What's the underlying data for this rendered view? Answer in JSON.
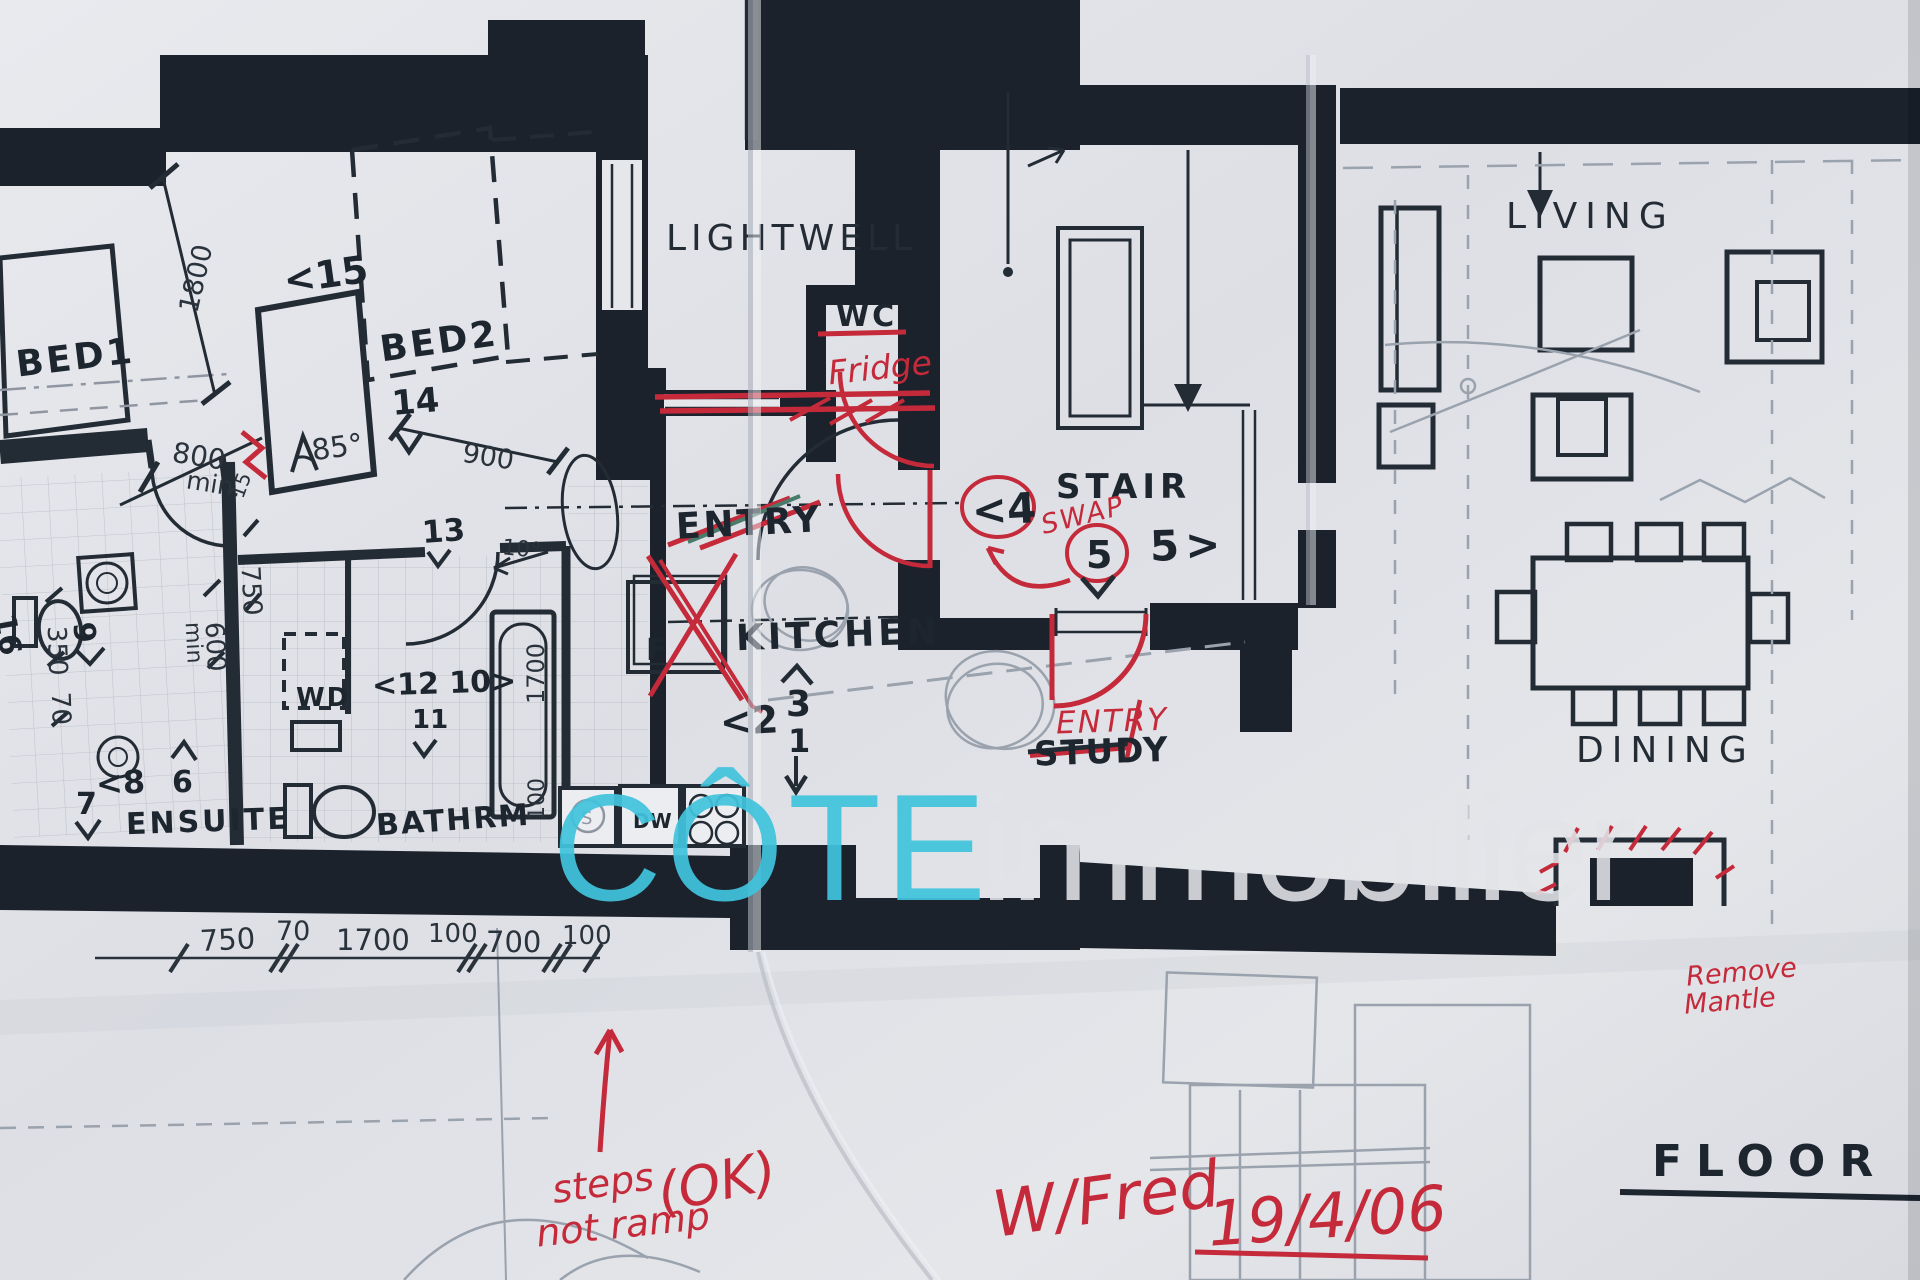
{
  "watermark": {
    "brand": "CÔTE",
    "suffix": "immobilier",
    "brand_color": "#41c4dd",
    "suffix_color": "#e3e4e8"
  },
  "title": {
    "floor_plan": "FLOOR PLA"
  },
  "rooms": {
    "bed1": "BED1",
    "bed2": "BED2",
    "lightwell": "LIGHTWELL",
    "wc": "WC",
    "kitchen": "KITCHEN",
    "entry_old": "ENTRY",
    "stair": "STAIR",
    "living": "LIVING",
    "dining": "DINING",
    "ensuite": "ENSUITE",
    "bathroom": "BATHRM",
    "laundry": "WD",
    "study_old": "STUDY",
    "fridge_box": "F",
    "dishwasher": "DW",
    "sink": "S"
  },
  "red_notes": {
    "fridge": "Fridge",
    "swap": "SWAP",
    "entry_new": "ENTRY",
    "steps": "steps",
    "ramp": "not ramp",
    "ok": "(OK)",
    "meeting": "W/Fred",
    "date": "19/4/06",
    "mantle_line1": "Remove",
    "mantle_line2": "Mantle"
  },
  "markers": {
    "m1": "1",
    "m2": "<2",
    "m3": "3",
    "m4": "<4",
    "m5": "5",
    "m5r": "5>",
    "m6": "6",
    "m7": "7",
    "m8": "<8",
    "m9": "9",
    "m11": "11",
    "m12_10": "<12 10>",
    "m13": "13",
    "m14": "14",
    "m15": "<15",
    "m16": "16"
  },
  "dims": {
    "d1800": "1800",
    "d800": "800",
    "dmin800": "min.",
    "d900": "900",
    "a10": "10°",
    "a85": "85°",
    "d15": "15",
    "d750v": "750",
    "d600v": "600",
    "dmin600": "min",
    "d350v": "350",
    "d70v": "70",
    "d1700v": "1700",
    "d100v": "100",
    "chain": [
      "750",
      "70",
      "1700",
      "100",
      "700",
      "100"
    ]
  },
  "colors": {
    "ink": "#232b35",
    "wall": "#1b222c",
    "red": "#c42a3a",
    "cyan": "#41c4dd",
    "pencil": "#939aa6",
    "paper": "#e2e3e8"
  }
}
